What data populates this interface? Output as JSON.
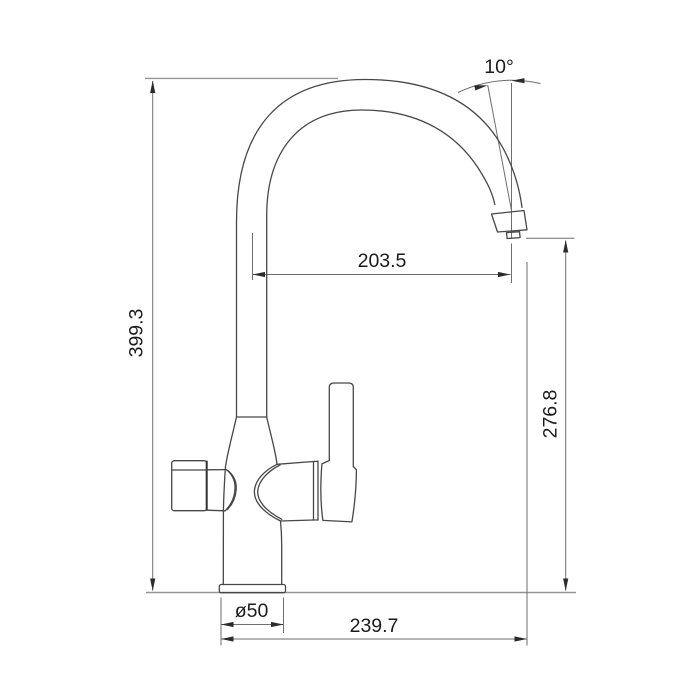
{
  "drawing": {
    "type": "faucet-technical-dimension-drawing",
    "dimensions": {
      "total_height": "399.3",
      "spout_reach": "203.5",
      "spout_outlet_height": "276.8",
      "overall_reach": "239.7",
      "base_diameter": "ø50",
      "outlet_angle": "10°"
    },
    "colors": {
      "background": "#ffffff",
      "outline": "#474747",
      "extension_line": "#949494",
      "dimension_line": "#6e6e6e",
      "text": "#1b1b1b"
    }
  }
}
